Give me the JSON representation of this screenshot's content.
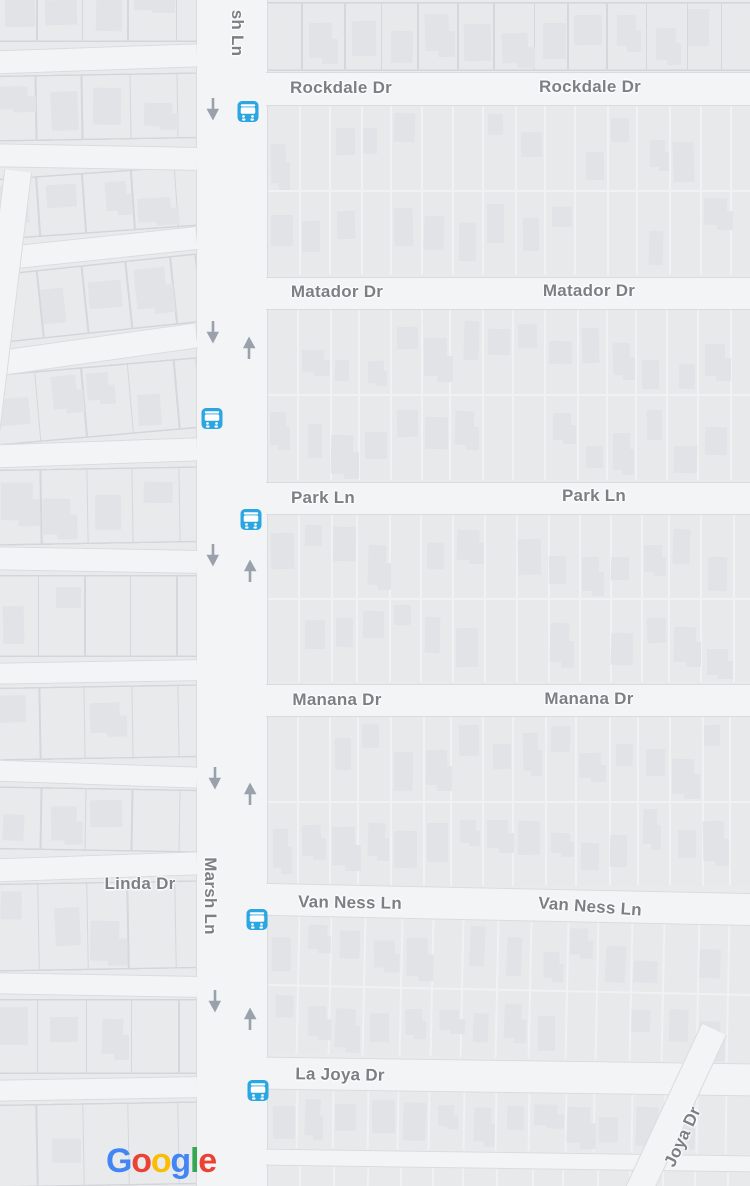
{
  "colors": {
    "land": "#e9eaec",
    "road": "#f3f4f5",
    "road_casing": "#d9dbde",
    "block_fill": "#e7e9ea",
    "lot_line_light": "#eff1f3",
    "lot_line_dark": "#d4d7db",
    "block_outline": "#d2d5d9",
    "building": "#e1e3e6",
    "label_text": "#7c8085",
    "arrow": "#9aa1ad",
    "bus_stop": "#2ba6e0",
    "google_blue": "#4285F4",
    "google_red": "#EA4335",
    "google_yellow": "#FBBC05",
    "google_green": "#34A853"
  },
  "street_labels": [
    {
      "id": "marsh-ln-top",
      "text": "sh Ln",
      "x": 237,
      "y": 33,
      "rotation": 90
    },
    {
      "id": "rockdale-dr-west",
      "text": "Rockdale Dr",
      "x": 341,
      "y": 88,
      "rotation": 0
    },
    {
      "id": "rockdale-dr-east",
      "text": "Rockdale Dr",
      "x": 590,
      "y": 87,
      "rotation": 0
    },
    {
      "id": "matador-dr-west",
      "text": "Matador Dr",
      "x": 337,
      "y": 292,
      "rotation": 0
    },
    {
      "id": "matador-dr-east",
      "text": "Matador Dr",
      "x": 589,
      "y": 291,
      "rotation": 0
    },
    {
      "id": "park-ln-west",
      "text": "Park Ln",
      "x": 323,
      "y": 498,
      "rotation": 0
    },
    {
      "id": "park-ln-east",
      "text": "Park Ln",
      "x": 594,
      "y": 496,
      "rotation": 0
    },
    {
      "id": "manana-dr-west",
      "text": "Manana Dr",
      "x": 337,
      "y": 700,
      "rotation": 0
    },
    {
      "id": "manana-dr-east",
      "text": "Manana Dr",
      "x": 589,
      "y": 699,
      "rotation": 0
    },
    {
      "id": "linda-dr",
      "text": "Linda Dr",
      "x": 140,
      "y": 884,
      "rotation": 0
    },
    {
      "id": "marsh-ln",
      "text": "Marsh Ln",
      "x": 210,
      "y": 896,
      "rotation": 90
    },
    {
      "id": "van-ness-ln-west",
      "text": "Van Ness Ln",
      "x": 350,
      "y": 903,
      "rotation": 1
    },
    {
      "id": "van-ness-ln-east",
      "text": "Van Ness Ln",
      "x": 590,
      "y": 907,
      "rotation": 4
    },
    {
      "id": "la-joya-dr",
      "text": "La Joya Dr",
      "x": 340,
      "y": 1075,
      "rotation": 1
    },
    {
      "id": "joya-dr",
      "text": "Joya Dr",
      "x": 683,
      "y": 1137,
      "rotation": -65
    }
  ],
  "transit_stops": [
    {
      "x": 248,
      "y": 114
    },
    {
      "x": 212,
      "y": 421
    },
    {
      "x": 251,
      "y": 522
    },
    {
      "x": 257,
      "y": 922
    },
    {
      "x": 258,
      "y": 1093
    }
  ],
  "one_way_arrows": [
    {
      "x": 213,
      "y": 112,
      "direction": "down"
    },
    {
      "x": 213,
      "y": 335,
      "direction": "down"
    },
    {
      "x": 249,
      "y": 345,
      "direction": "up"
    },
    {
      "x": 213,
      "y": 558,
      "direction": "down"
    },
    {
      "x": 250,
      "y": 568,
      "direction": "up"
    },
    {
      "x": 215,
      "y": 781,
      "direction": "down"
    },
    {
      "x": 250,
      "y": 791,
      "direction": "up"
    },
    {
      "x": 215,
      "y": 1004,
      "direction": "down"
    },
    {
      "x": 250,
      "y": 1016,
      "direction": "up"
    }
  ],
  "map_attribution": {
    "text": "Google",
    "letters": [
      {
        "ch": "G",
        "color": "#4285F4"
      },
      {
        "ch": "o",
        "color": "#EA4335"
      },
      {
        "ch": "o",
        "color": "#FBBC05"
      },
      {
        "ch": "g",
        "color": "#4285F4"
      },
      {
        "ch": "l",
        "color": "#34A853"
      },
      {
        "ch": "e",
        "color": "#EA4335"
      }
    ]
  }
}
